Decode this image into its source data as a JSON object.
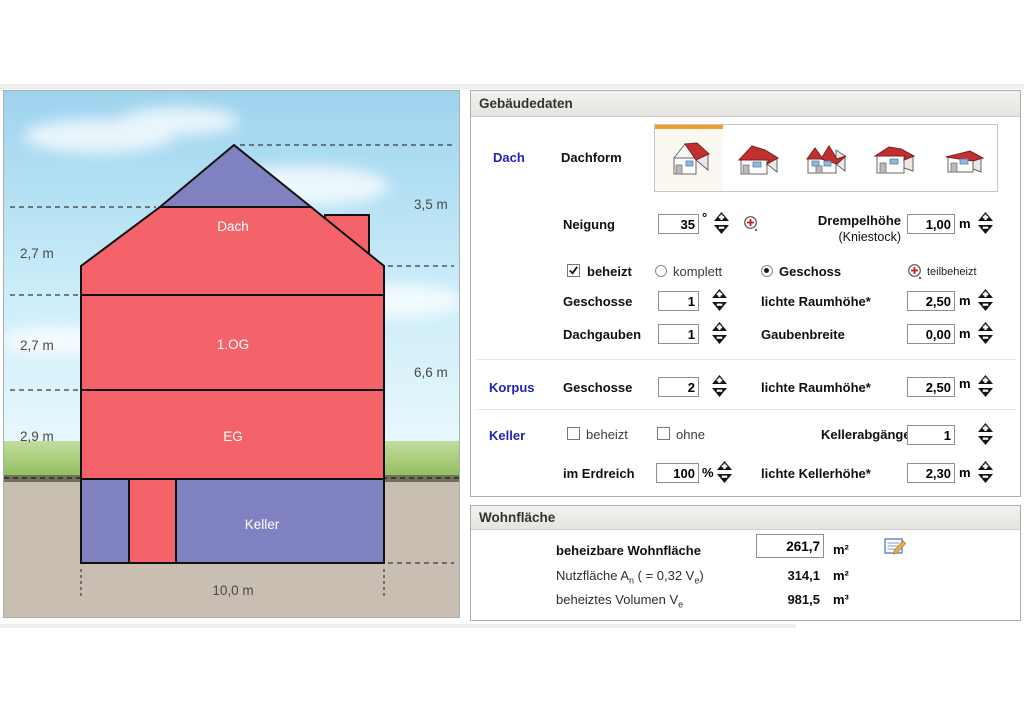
{
  "diagram": {
    "labels": {
      "dach": "Dach",
      "og": "1.OG",
      "eg": "EG",
      "keller": "Keller"
    },
    "measurements": {
      "m_dach": "2,7 m",
      "m_og": "2,7 m",
      "m_eg": "2,9 m",
      "m_roof": "3,5 m",
      "m_wall": "6,6 m",
      "m_width": "10,0 m"
    },
    "colors": {
      "heated": "#f5636a",
      "unheated": "#8081c0",
      "ground": "#c9beb2"
    }
  },
  "gebaeudedaten": {
    "title": "Gebäudedaten",
    "dach": {
      "section_label": "Dach",
      "dachform_label": "Dachform",
      "roof_icons": [
        "gable-roof-house-icon",
        "hip-roof-house-icon",
        "cross-gable-house-icon",
        "pavilion-roof-house-icon",
        "flat-roof-house-icon"
      ],
      "selected_roof_index": 0,
      "neigung_label": "Neigung",
      "neigung_value": "35",
      "neigung_unit": "°",
      "drempel_label": "Drempelhöhe",
      "drempel_sublabel": "(Kniestock)",
      "drempel_value": "1,00",
      "drempel_unit": "m",
      "beheizt_label": "beheizt",
      "beheizt_checked": true,
      "komplett_label": "komplett",
      "komplett_selected": false,
      "geschoss_label": "Geschoss",
      "geschoss_selected": true,
      "teilbeheizt_label": "teilbeheizt",
      "geschosse_label": "Geschosse",
      "geschosse_value": "1",
      "raumhoehe_label": "lichte Raumhöhe*",
      "raumhoehe_value": "2,50",
      "raumhoehe_unit": "m",
      "dachgauben_label": "Dachgauben",
      "dachgauben_value": "1",
      "gaubenbreite_label": "Gaubenbreite",
      "gaubenbreite_value": "0,00",
      "gaubenbreite_unit": "m"
    },
    "korpus": {
      "section_label": "Korpus",
      "geschosse_label": "Geschosse",
      "geschosse_value": "2",
      "raumhoehe_label": "lichte Raumhöhe*",
      "raumhoehe_value": "2,50",
      "raumhoehe_unit": "m"
    },
    "keller": {
      "section_label": "Keller",
      "beheizt_label": "beheizt",
      "beheizt_checked": false,
      "ohne_label": "ohne",
      "ohne_checked": false,
      "abgaenge_label": "Kellerabgänge",
      "abgaenge_value": "1",
      "erdreich_label": "im Erdreich",
      "erdreich_value": "100",
      "erdreich_unit": "%",
      "kellerhoehe_label": "lichte Kellerhöhe*",
      "kellerhoehe_value": "2,30",
      "kellerhoehe_unit": "m"
    }
  },
  "wohnflaeche": {
    "title": "Wohnfläche",
    "beheizbar_label": "beheizbare Wohnfläche",
    "beheizbar_value": "261,7",
    "beheizbar_unit": "m²",
    "nutz_p1": "Nutzfläche A",
    "nutz_sub1": "n",
    "nutz_p2": " ( = 0,32 V",
    "nutz_sub2": "e",
    "nutz_p3": ")",
    "nutz_value": "314,1",
    "nutz_unit": "m²",
    "vol_p1": "beheiztes Volumen V",
    "vol_sub1": "e",
    "vol_value": "981,5",
    "vol_unit": "m³"
  }
}
